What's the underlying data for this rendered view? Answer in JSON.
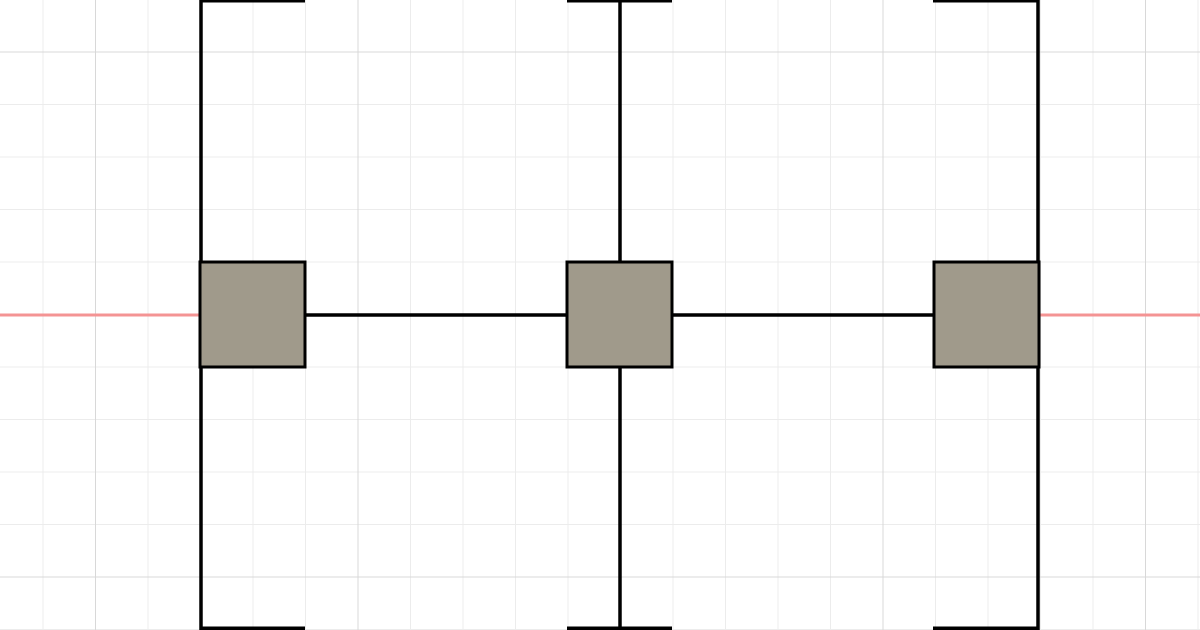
{
  "canvas": {
    "width": 1200,
    "height": 630,
    "background_color": "#ffffff",
    "grid": {
      "minor_spacing": 52.5,
      "major_spacing": 262.5,
      "minor_color": "#ececec",
      "major_color": "#d8d8d8",
      "minor_offset_x": 43,
      "minor_offset_y": 52,
      "major_offset_x": 95.5,
      "major_offset_y": 52,
      "line_width": 1
    },
    "guide_line": {
      "orientation": "horizontal",
      "y": 315,
      "thickness": 3,
      "color": "#f49494"
    }
  },
  "diagram": {
    "wire_color": "#000000",
    "wire_thickness": 3.5,
    "node_fill_color": "#a09a8b",
    "node_stroke_color": "#000000",
    "node_stroke_thickness": 3,
    "vertical_wires": [
      {
        "x": 201,
        "y1": 0,
        "y2": 630
      },
      {
        "x": 620,
        "y1": 0,
        "y2": 630
      },
      {
        "x": 1038,
        "y1": 0,
        "y2": 630
      }
    ],
    "connectors": [
      {
        "x1": 305,
        "x2": 567,
        "y": 315
      },
      {
        "x1": 672,
        "x2": 934,
        "y": 315
      }
    ],
    "nodes": [
      {
        "x": 200,
        "y": 262,
        "width": 105,
        "height": 105
      },
      {
        "x": 567,
        "y": 262,
        "width": 105,
        "height": 105
      },
      {
        "x": 934,
        "y": 262,
        "width": 105,
        "height": 105
      }
    ],
    "clipped_node_edges": [
      {
        "x1": 200,
        "x2": 305,
        "y": 0.8,
        "edge": "top"
      },
      {
        "x1": 567,
        "x2": 672,
        "y": 0.8,
        "edge": "top"
      },
      {
        "x1": 933,
        "x2": 1038,
        "y": 0.8,
        "edge": "top"
      },
      {
        "x1": 200,
        "x2": 305,
        "y": 628.2,
        "edge": "bottom"
      },
      {
        "x1": 567,
        "x2": 672,
        "y": 628.2,
        "edge": "bottom"
      },
      {
        "x1": 933,
        "x2": 1038,
        "y": 628.2,
        "edge": "bottom"
      }
    ]
  }
}
